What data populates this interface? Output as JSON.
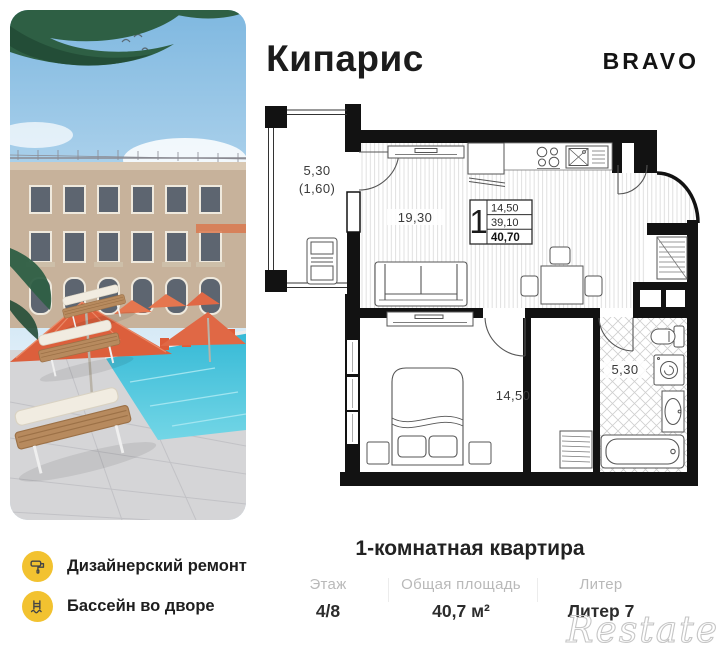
{
  "header": {
    "title": "Кипарис",
    "brand": "BRAVO"
  },
  "floorplan": {
    "balcony": {
      "area": "5,30",
      "area_reduced": "(1,60)"
    },
    "living_kitchen": {
      "area": "19,30"
    },
    "bedroom": {
      "area": "14,50"
    },
    "bathroom": {
      "area": "5,30"
    },
    "info_box": {
      "rooms": "1",
      "living_area": "14,50",
      "area_without_balcony": "39,10",
      "total_area": "40,70"
    }
  },
  "features": [
    {
      "icon": "paint-roller-icon",
      "label": "Дизайнерский ремонт"
    },
    {
      "icon": "pool-ladder-icon",
      "label": "Бассейн во дворе"
    }
  ],
  "summary": {
    "title": "1-комнатная квартира",
    "stats": [
      {
        "label": "Этаж",
        "value": "4/8"
      },
      {
        "label": "Общая площадь",
        "value": "40,7 м²"
      },
      {
        "label": "Литер",
        "value": "Литер 7"
      }
    ]
  },
  "watermark": "Restate",
  "colors": {
    "accent_yellow": "#F2C230",
    "wall_black": "#121212",
    "text_dark": "#1e1e1e",
    "muted_gray": "#b9b9b9",
    "umbrella_coral": "#DC5F3C",
    "pool_blue": "#49C3DA"
  }
}
